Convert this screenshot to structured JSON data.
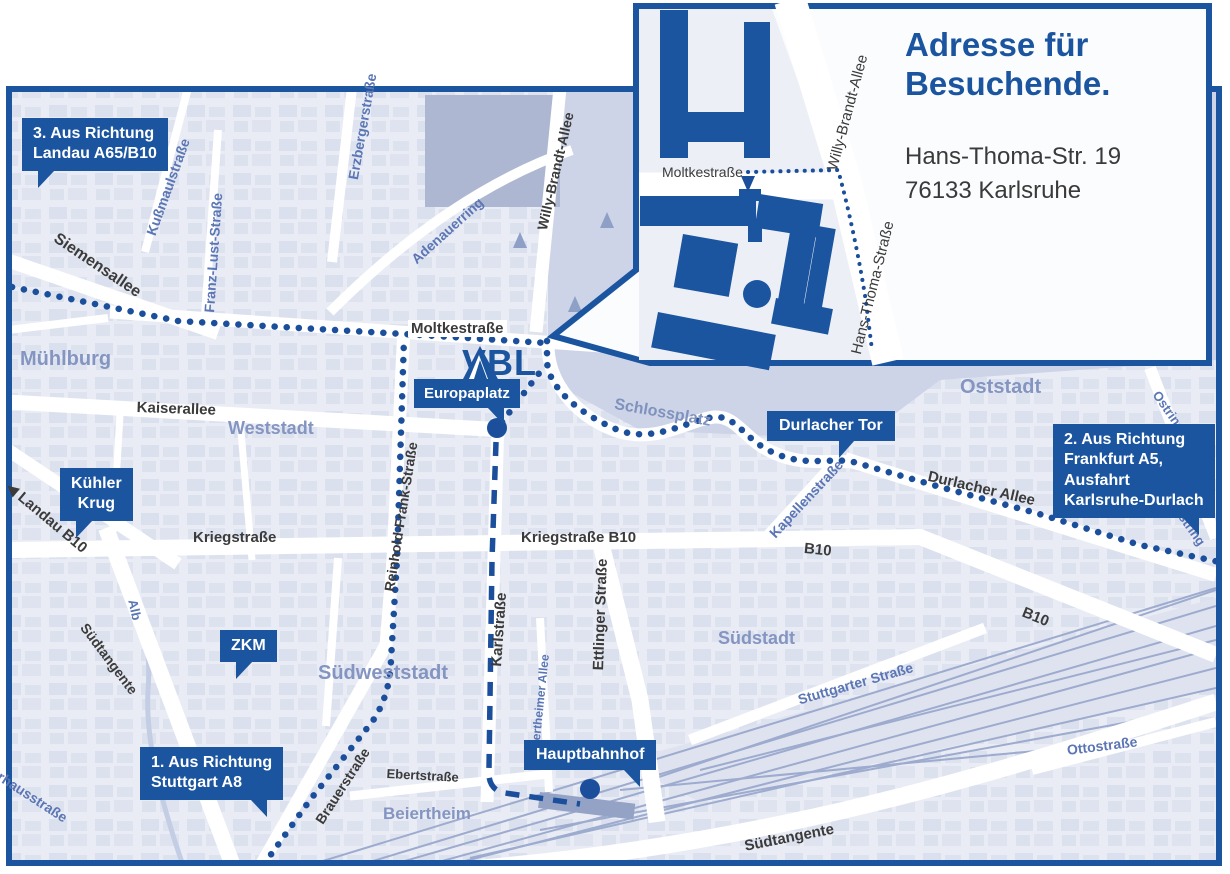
{
  "inset": {
    "title_line1": "Adresse für",
    "title_line2": "Besuchende.",
    "address_line1": "Hans-Thoma-Str. 19",
    "address_line2": "76133 Karlsruhe",
    "street_moltkestrasse": "Moltkestraße",
    "street_willy_brandt_allee": "Willy-Brandt-Allee",
    "street_hans_thoma_strasse": "Hans-Thoma-Straße"
  },
  "logo": {
    "text": "VBL"
  },
  "markers": {
    "landau": {
      "line1": "3. Aus Richtung",
      "line2": "Landau A65/B10"
    },
    "frankfurt": {
      "line1": "2. Aus Richtung",
      "line2": "Frankfurt A5,",
      "line3": "Ausfahrt",
      "line4": "Karlsruhe-Durlach"
    },
    "stuttgart": {
      "line1": "1. Aus Richtung",
      "line2": "Stuttgart A8"
    },
    "kuehler_krug": {
      "line1": "Kühler",
      "line2": "Krug"
    },
    "zkm": {
      "label": "ZKM"
    },
    "europaplatz": {
      "label": "Europaplatz"
    },
    "durlacher_tor": {
      "label": "Durlacher Tor"
    },
    "hauptbahnhof": {
      "label": "Hauptbahnhof"
    }
  },
  "streets": {
    "moltkestrasse": "Moltkestraße",
    "kaiserallee": "Kaiserallee",
    "kriegstrasse": "Kriegstraße",
    "kriegstrasse_b10": "Kriegstraße B10",
    "b10_east": "B10",
    "b10_southeast": "B10",
    "durlacher_allee": "Durlacher Allee",
    "karlstrasse": "Karlstraße",
    "ettlinger_strasse": "Ettlinger Straße",
    "reinhold_frank_strasse": "Reinhold-Frank-Straße",
    "siemensallee": "Siemensallee",
    "willy_brandt_allee": "Willy-Brandt-Allee",
    "landau_b10": "◀ Landau B10",
    "brauerstrasse": "Brauerstraße",
    "ebertstrasse": "Ebertstraße",
    "steinhaeuserstrasse": "Steinhäuserstraße",
    "suedtangente_west": "Südtangente",
    "suedtangente_east": "Südtangente",
    "kussmaulstrasse": "Kußmaulstraße",
    "franz_lust_strasse": "Franz-Lust-Straße",
    "erzbergerstrasse": "Erzbergerstraße",
    "adenauerring": "Adenauerring",
    "kapellenstrasse": "Kapellenstraße",
    "ostring": "Ostring",
    "ostring_south": "Ostring",
    "stuttgarter_strasse": "Stuttgarter Straße",
    "ottostrasse": "Ottostraße",
    "beiertheimer_allee": "Beiertheimer Allee",
    "pulverhausstrasse": "Pulverhausstraße",
    "alb": "Alb"
  },
  "districts": {
    "muehlburg": "Mühlburg",
    "weststadt": "Weststadt",
    "suedweststadt": "Südweststadt",
    "suedstadt": "Südstadt",
    "oststadt": "Oststadt",
    "beiertheim": "Beiertheim",
    "schlossplatz": "Schlossplatz"
  },
  "colors": {
    "brand_blue": "#1b55a0",
    "route_blue": "#1b4f9c",
    "map_background": "#e9ecf4",
    "district_label": "#8495c1",
    "minor_street_label": "#5b76b4"
  }
}
